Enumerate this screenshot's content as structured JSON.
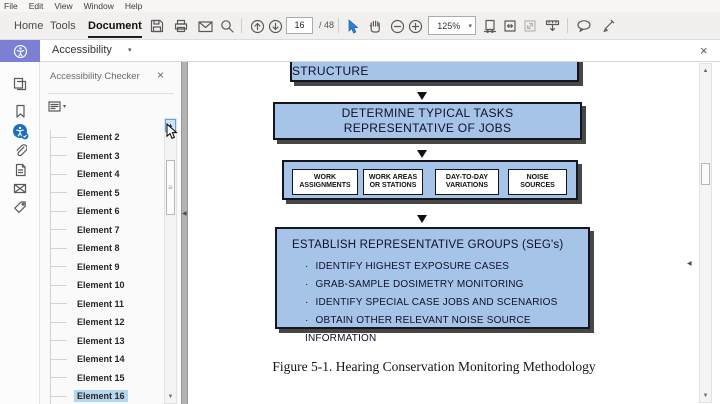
{
  "menu_bar": {
    "items": [
      "File",
      "Edit",
      "View",
      "Window",
      "Help"
    ]
  },
  "toolbar": {
    "tabs": [
      {
        "label": "Home",
        "active": false
      },
      {
        "label": "Tools",
        "active": false
      },
      {
        "label": "Document",
        "active": true
      }
    ],
    "page_current": "16",
    "page_total": "/ 48",
    "zoom_level": "125%",
    "icons": [
      "save-icon",
      "print-icon",
      "email-icon",
      "search-icon",
      "page-up-icon",
      "page-down-icon",
      "select-tool-icon",
      "hand-tool-icon",
      "zoom-out-icon",
      "zoom-in-icon",
      "fit-width-icon",
      "fit-page-icon",
      "actual-size-icon",
      "fit-visible-icon",
      "comment-icon",
      "highlight-icon"
    ]
  },
  "accessibility_bar": {
    "label": "Accessibility"
  },
  "sidebar_icons": [
    "page-thumbnails-icon",
    "bookmarks-icon",
    "accessibility-icon",
    "attachments-icon",
    "articles-icon",
    "destinations-icon",
    "tags-icon"
  ],
  "panel": {
    "title": "Accessibility Checker",
    "elements": [
      "Element 2",
      "Element 3",
      "Element 4",
      "Element 5",
      "Element 6",
      "Element 7",
      "Element 8",
      "Element 9",
      "Element 10",
      "Element 11",
      "Element 12",
      "Element 13",
      "Element 14",
      "Element 15",
      "Element 16"
    ],
    "selected_element": "Element 16"
  },
  "document": {
    "flowchart": {
      "top_box": "DETERMINE OVERALL WORK FORCE STRUCTURE",
      "box2_line1": "DETERMINE TYPICAL TASKS",
      "box2_line2": "REPRESENTATIVE OF JOBS",
      "sub_boxes": [
        "WORK ASSIGNMENTS",
        "WORK AREAS OR STATIONS",
        "DAY-TO-DAY VARIATIONS",
        "NOISE SOURCES"
      ],
      "bottom_title": "ESTABLISH REPRESENTATIVE GROUPS (SEG's)",
      "bullets": [
        "IDENTIFY HIGHEST EXPOSURE CASES",
        "GRAB-SAMPLE DOSIMETRY MONITORING",
        "IDENTIFY SPECIAL CASE JOBS AND SCENARIOS",
        "OBTAIN OTHER RELEVANT NOISE SOURCE INFORMATION"
      ]
    },
    "caption": "Figure 5-1. Hearing Conservation Monitoring Methodology"
  },
  "glyphs": {
    "close": "×",
    "caret_down": "▾",
    "scroll_up": "▲",
    "scroll_down": "▼",
    "collapse_left": "◀",
    "bullet": "·",
    "thumb_grip": "≡"
  },
  "colors": {
    "accent_purple": "#7c80d5",
    "flow_fill": "#a6c4e8",
    "selection_blue": "#b4d7ef",
    "active_tool_blue": "#1c6fbf"
  }
}
